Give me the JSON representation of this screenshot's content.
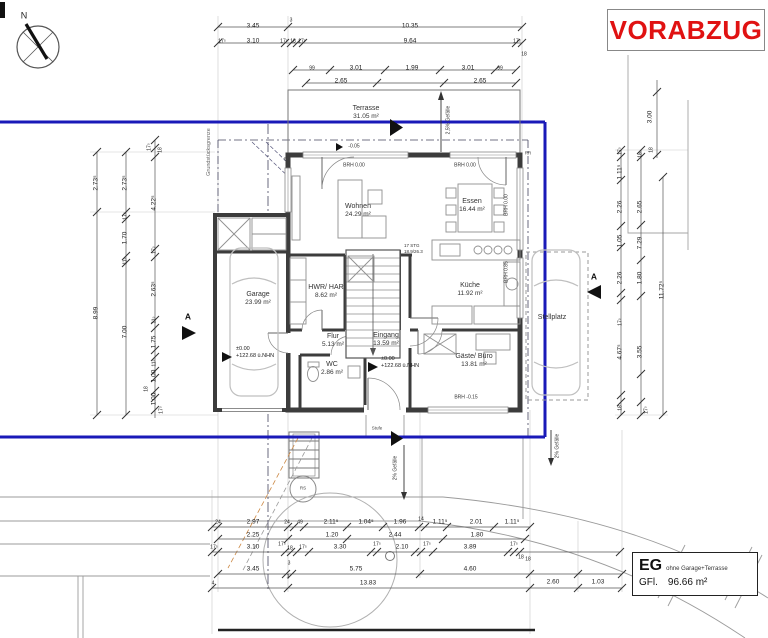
{
  "title": {
    "vorabzug": "VORABZUG"
  },
  "compass": {
    "north": "N"
  },
  "legend": {
    "floor": "EG",
    "note": "ohne Garage+Terrasse",
    "gfl_label": "GFl.",
    "gfl_value": "96.66 m²"
  },
  "site": {
    "boundary_label": "Grundstücksgrenze"
  },
  "rooms": {
    "terrasse": {
      "name": "Terrasse",
      "area": "31.05 m²"
    },
    "wohnen": {
      "name": "Wohnen",
      "area": "24.29 m²"
    },
    "essen": {
      "name": "Essen",
      "area": "16.44 m²"
    },
    "kueche": {
      "name": "Küche",
      "area": "11.92 m²"
    },
    "hwr": {
      "name": "HWR/ HAR",
      "area": "8.62 m²"
    },
    "flur": {
      "name": "Flur",
      "area": "5.13 m²"
    },
    "eingang": {
      "name": "Eingang",
      "area": "13.59 m²"
    },
    "wc": {
      "name": "WC",
      "area": "2.86 m²"
    },
    "gaeste": {
      "name": "Gäste/ Büro",
      "area": "13.81 m²"
    },
    "garage": {
      "name": "Garage",
      "area": "23.99 m²"
    },
    "stellplatz": {
      "name": "Stellplatz"
    }
  },
  "stairs": {
    "line1": "17 STG",
    "line2": "18.9/26.3"
  },
  "levels": {
    "garage": {
      "l1": "±0.00",
      "l2": "+122.68 ü.NHN"
    },
    "eingang": {
      "l1": "±0.00",
      "l2": "+122.68 ü.NHN"
    },
    "terrasse": "-0.05"
  },
  "marks": {
    "brh_top_left": "BRH 0.00",
    "brh_top_right": "BRH 0.00",
    "brh_right_essen": "BRH 0.00",
    "brh_right_kueche": "BRH 0.85",
    "brh_gaeste": "BRH -0.15",
    "rr_left": "RR",
    "rr_right": "RR",
    "rs": "RS",
    "stufe": "Stufe",
    "section": "A",
    "slope_top": "2,5% Gefälle",
    "slope_bottom": "2% Gefälle",
    "slope_right": "2% Gefälle"
  },
  "dims": {
    "labels": [
      {
        "t": "3.45",
        "x": 253,
        "y": 27
      },
      {
        "t": "3",
        "x": 291,
        "y": 21,
        "s": 1
      },
      {
        "t": "10.35",
        "x": 410,
        "y": 27
      },
      {
        "t": "17⁵",
        "x": 222,
        "y": 42,
        "s": 1
      },
      {
        "t": "3.10",
        "x": 253,
        "y": 42
      },
      {
        "t": "17⁵",
        "x": 284,
        "y": 42,
        "s": 1
      },
      {
        "t": "18",
        "x": 293,
        "y": 42,
        "s": 1
      },
      {
        "t": "17⁵",
        "x": 302,
        "y": 42,
        "s": 1
      },
      {
        "t": "9.64",
        "x": 410,
        "y": 42
      },
      {
        "t": "17⁵",
        "x": 517,
        "y": 42,
        "s": 1
      },
      {
        "t": "18",
        "x": 524,
        "y": 55,
        "s": 1
      },
      {
        "t": "99",
        "x": 312,
        "y": 69,
        "s": 1
      },
      {
        "t": "3.01",
        "x": 356,
        "y": 69
      },
      {
        "t": "1.99",
        "x": 412,
        "y": 69
      },
      {
        "t": "3.01",
        "x": 468,
        "y": 69
      },
      {
        "t": "99",
        "x": 500,
        "y": 69,
        "s": 1
      },
      {
        "t": "2.65",
        "x": 341,
        "y": 82
      },
      {
        "t": "2.65",
        "x": 480,
        "y": 82
      },
      {
        "t": "3.00",
        "x": 651,
        "y": 117,
        "r": 1
      },
      {
        "t": "2.73⁵",
        "x": 97,
        "y": 183,
        "r": 1
      },
      {
        "t": "8.99",
        "x": 97,
        "y": 313,
        "r": 1
      },
      {
        "t": "2.73⁵",
        "x": 126,
        "y": 183,
        "r": 1
      },
      {
        "t": "17⁵",
        "x": 126,
        "y": 216,
        "r": 1,
        "s": 1
      },
      {
        "t": "1.70",
        "x": 126,
        "y": 238,
        "r": 1
      },
      {
        "t": "11⁵",
        "x": 126,
        "y": 261,
        "r": 1,
        "s": 1
      },
      {
        "t": "7.00",
        "x": 126,
        "y": 332,
        "r": 1
      },
      {
        "t": "17⁵",
        "x": 150,
        "y": 147,
        "r": 1,
        "s": 1
      },
      {
        "t": "18",
        "x": 161,
        "y": 150,
        "r": 1,
        "s": 1
      },
      {
        "t": "4.22⁵",
        "x": 155,
        "y": 203,
        "r": 1
      },
      {
        "t": "17⁵",
        "x": 155,
        "y": 250,
        "r": 1,
        "s": 1
      },
      {
        "t": "2.63⁵",
        "x": 155,
        "y": 289,
        "r": 1
      },
      {
        "t": "11⁵",
        "x": 155,
        "y": 320,
        "r": 1,
        "s": 1
      },
      {
        "t": "1.75",
        "x": 155,
        "y": 342,
        "r": 1
      },
      {
        "t": "11⁵",
        "x": 155,
        "y": 363,
        "r": 1,
        "s": 1
      },
      {
        "t": "1.00",
        "x": 155,
        "y": 376,
        "r": 1
      },
      {
        "t": "18",
        "x": 147,
        "y": 389,
        "r": 1,
        "s": 1
      },
      {
        "t": "1.00",
        "x": 155,
        "y": 399,
        "r": 1
      },
      {
        "t": "17⁵",
        "x": 162,
        "y": 410,
        "r": 1,
        "s": 1
      },
      {
        "t": "17⁵",
        "x": 621,
        "y": 151,
        "r": 1,
        "s": 1
      },
      {
        "t": "1.11⁵",
        "x": 621,
        "y": 172,
        "r": 1
      },
      {
        "t": "2.26",
        "x": 621,
        "y": 207,
        "r": 1
      },
      {
        "t": "1.05",
        "x": 621,
        "y": 241,
        "r": 1
      },
      {
        "t": "2.26",
        "x": 621,
        "y": 278,
        "r": 1
      },
      {
        "t": "17⁵",
        "x": 621,
        "y": 322,
        "r": 1,
        "s": 1
      },
      {
        "t": "4.67⁵",
        "x": 621,
        "y": 352,
        "r": 1
      },
      {
        "t": "18",
        "x": 621,
        "y": 408,
        "r": 1,
        "s": 1
      },
      {
        "t": "18",
        "x": 641,
        "y": 155,
        "r": 1,
        "s": 1
      },
      {
        "t": "2.65",
        "x": 641,
        "y": 207,
        "r": 1
      },
      {
        "t": "7.29",
        "x": 641,
        "y": 243,
        "r": 1
      },
      {
        "t": "1.80",
        "x": 641,
        "y": 278,
        "r": 1
      },
      {
        "t": "3.55",
        "x": 641,
        "y": 352,
        "r": 1
      },
      {
        "t": "17⁵",
        "x": 647,
        "y": 410,
        "r": 1,
        "s": 1
      },
      {
        "t": "18",
        "x": 652,
        "y": 150,
        "r": 1,
        "s": 1
      },
      {
        "t": "11.72⁵",
        "x": 663,
        "y": 290,
        "r": 1
      },
      {
        "t": "24",
        "x": 218,
        "y": 523,
        "s": 1
      },
      {
        "t": "2.97",
        "x": 253,
        "y": 523
      },
      {
        "t": "24",
        "x": 287,
        "y": 523,
        "s": 1
      },
      {
        "t": "49",
        "x": 300,
        "y": 523,
        "s": 1
      },
      {
        "t": "2.11⁵",
        "x": 331,
        "y": 523
      },
      {
        "t": "1.04⁵",
        "x": 366,
        "y": 523
      },
      {
        "t": "1.96",
        "x": 400,
        "y": 523
      },
      {
        "t": "14",
        "x": 421,
        "y": 520,
        "s": 1
      },
      {
        "t": "1.11⁵",
        "x": 440,
        "y": 523
      },
      {
        "t": "2.01",
        "x": 476,
        "y": 523
      },
      {
        "t": "1.11⁵",
        "x": 512,
        "y": 523
      },
      {
        "t": "2.25",
        "x": 253,
        "y": 536
      },
      {
        "t": "1.20",
        "x": 332,
        "y": 536
      },
      {
        "t": "2.44",
        "x": 395,
        "y": 536
      },
      {
        "t": "1.80",
        "x": 477,
        "y": 536
      },
      {
        "t": "17⁵",
        "x": 214,
        "y": 548,
        "s": 1
      },
      {
        "t": "3.10",
        "x": 253,
        "y": 548
      },
      {
        "t": "17⁵",
        "x": 282,
        "y": 545,
        "s": 1
      },
      {
        "t": "18",
        "x": 290,
        "y": 549,
        "s": 1
      },
      {
        "t": "17⁵",
        "x": 303,
        "y": 548,
        "s": 1
      },
      {
        "t": "3.30",
        "x": 340,
        "y": 548
      },
      {
        "t": "17⁵",
        "x": 377,
        "y": 545,
        "s": 1
      },
      {
        "t": "2.10",
        "x": 402,
        "y": 548
      },
      {
        "t": "17⁵",
        "x": 427,
        "y": 545,
        "s": 1
      },
      {
        "t": "3.89",
        "x": 470,
        "y": 548
      },
      {
        "t": "17⁵",
        "x": 514,
        "y": 545,
        "s": 1
      },
      {
        "t": "18",
        "x": 521,
        "y": 558,
        "s": 1
      },
      {
        "t": "3.45",
        "x": 253,
        "y": 570
      },
      {
        "t": "3",
        "x": 289,
        "y": 564,
        "s": 1
      },
      {
        "t": "5.75",
        "x": 356,
        "y": 570
      },
      {
        "t": "4.60",
        "x": 470,
        "y": 570
      },
      {
        "t": "18",
        "x": 528,
        "y": 560,
        "s": 1
      },
      {
        "t": "4",
        "x": 213,
        "y": 584,
        "s": 1
      },
      {
        "t": "3",
        "x": 288,
        "y": 578,
        "s": 1
      },
      {
        "t": "13.83",
        "x": 368,
        "y": 584
      },
      {
        "t": "2.60",
        "x": 553,
        "y": 583
      },
      {
        "t": "1.03",
        "x": 598,
        "y": 583
      }
    ]
  }
}
